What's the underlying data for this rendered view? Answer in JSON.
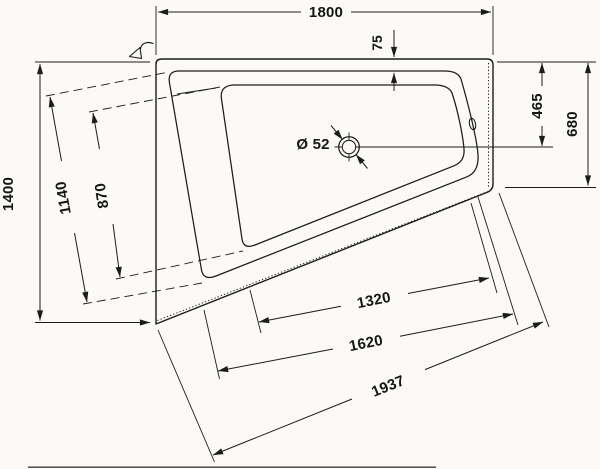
{
  "drawing": {
    "kind": "bathtub plan technical drawing",
    "colors": {
      "line": "#1c1c1c",
      "background": "#fbfaf7"
    },
    "dimensions": {
      "overall_width": "1800",
      "rim_to_inner_top": "75",
      "top_to_drain_center": "465",
      "right_edge_depth": "680",
      "overall_depth_left": "1400",
      "inner_rim_left_edge": "1140",
      "basin_left_edge": "870",
      "drain_diameter": "Ø 52",
      "basin_bottom_edge": "1320",
      "inner_rim_bottom_edge": "1620",
      "outer_bottom_edge": "1937"
    }
  }
}
